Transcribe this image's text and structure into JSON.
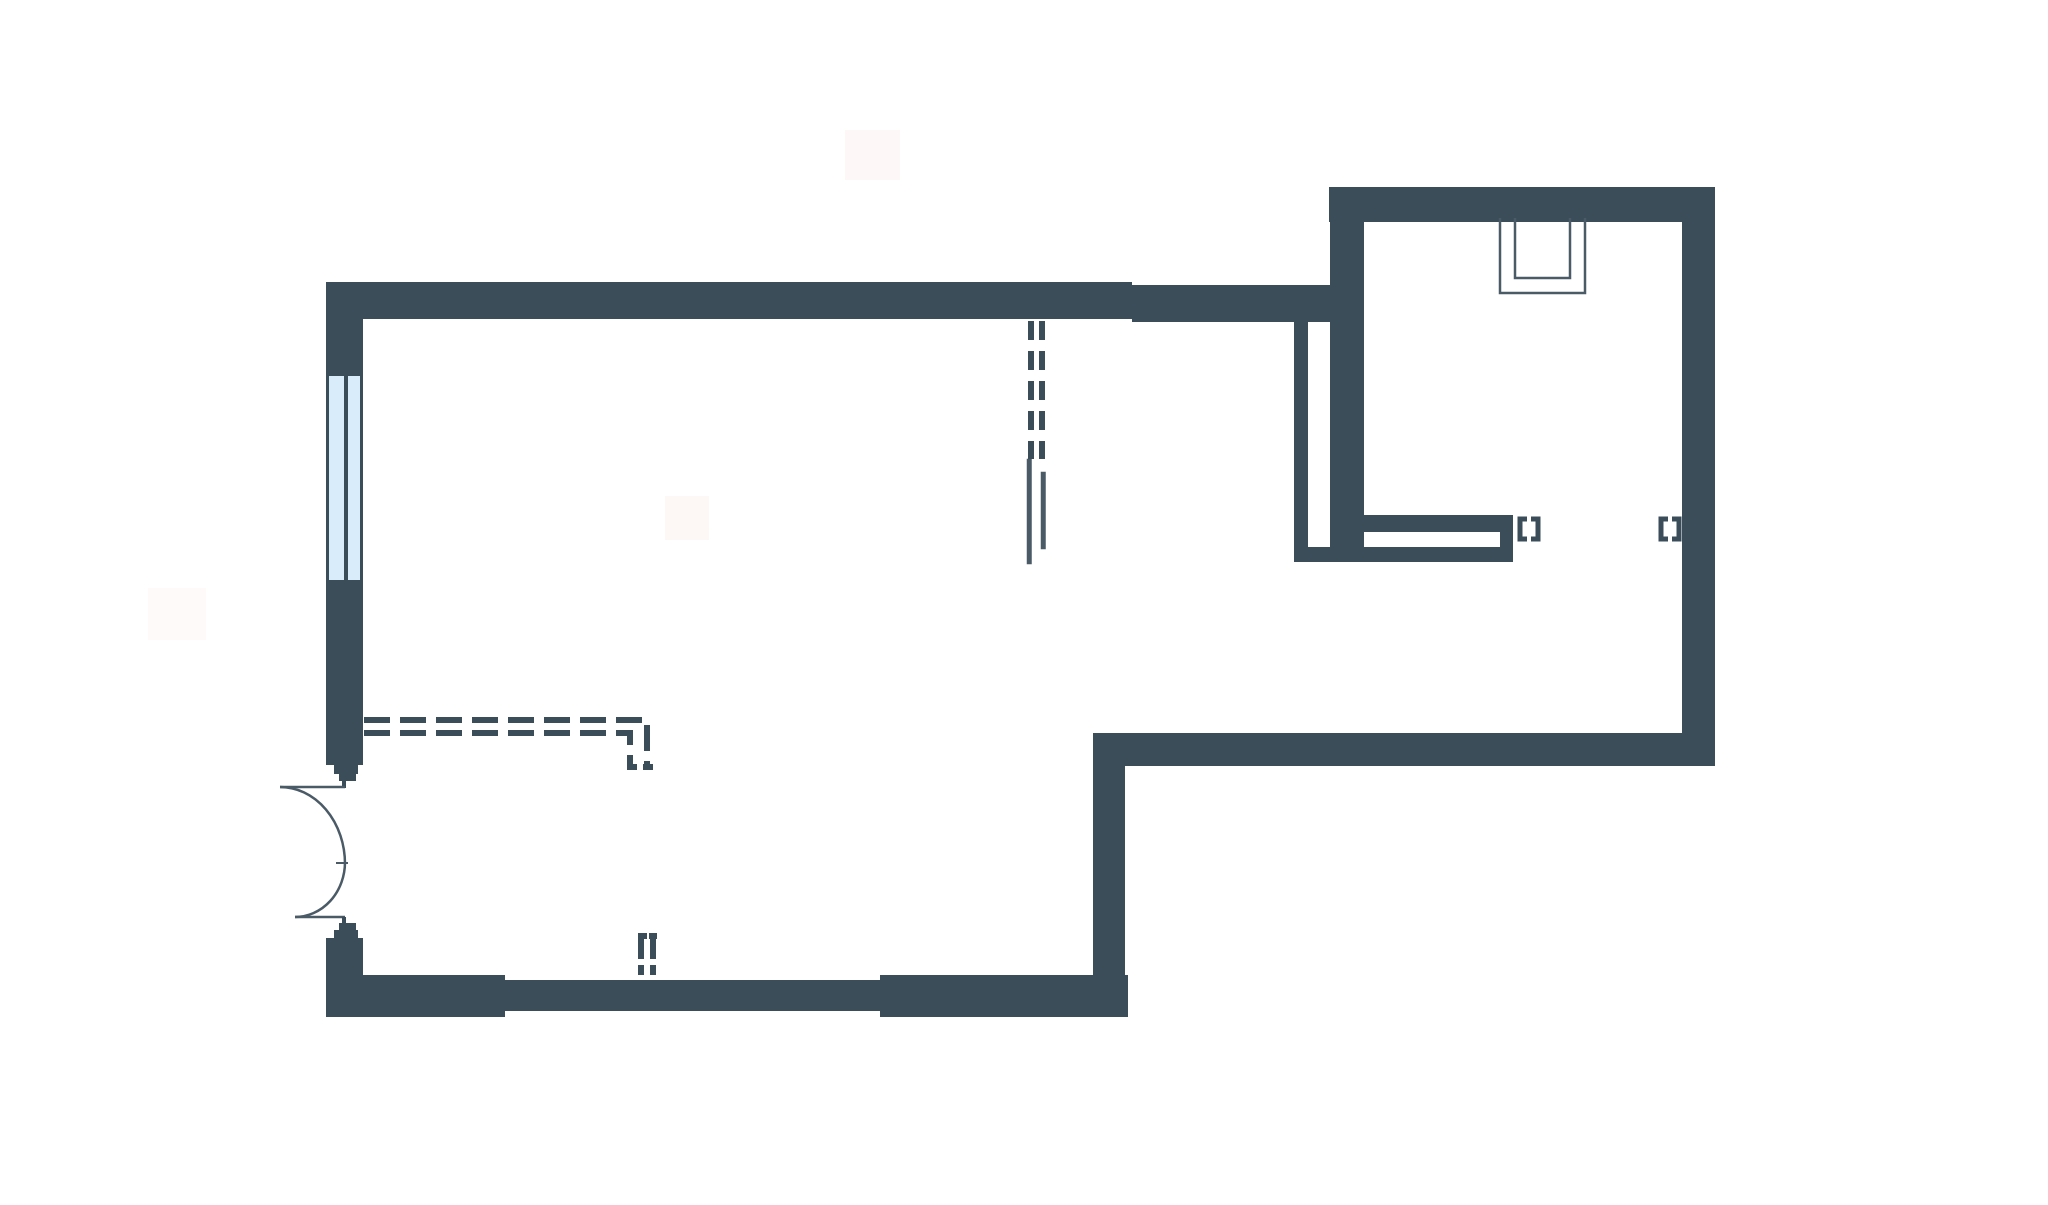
{
  "canvas": {
    "width": 2048,
    "height": 1205,
    "background": "#ffffff"
  },
  "palette": {
    "wall": "#3B4D59",
    "stroke": "#4A5A66",
    "pane": "#D9ECFA",
    "white": "#FFFFFF",
    "blob": "#FBF0ED"
  },
  "shapes": [
    {
      "name": "stain-blob-top",
      "kind": "rect",
      "x": 845,
      "y": 130,
      "w": 55,
      "h": 50,
      "fill": "blob",
      "opacity": 0.45
    },
    {
      "name": "stain-blob-mid",
      "kind": "rect",
      "x": 665,
      "y": 496,
      "w": 44,
      "h": 44,
      "fill": "blob",
      "opacity": 0.5
    },
    {
      "name": "stain-blob-left",
      "kind": "rect",
      "x": 148,
      "y": 588,
      "w": 58,
      "h": 52,
      "fill": "blob",
      "opacity": 0.35
    },
    {
      "name": "top-wall-main",
      "kind": "rect",
      "x": 329,
      "y": 282,
      "w": 803,
      "h": 37,
      "fill": "wall"
    },
    {
      "name": "top-wall-right",
      "kind": "rect",
      "x": 1132,
      "y": 285,
      "w": 198,
      "h": 37,
      "fill": "wall"
    },
    {
      "name": "left-wall-upper",
      "kind": "rect",
      "x": 326,
      "y": 282,
      "w": 37,
      "h": 483,
      "fill": "wall"
    },
    {
      "name": "window-pane-left",
      "kind": "rect",
      "x": 329,
      "y": 376,
      "w": 15,
      "h": 204,
      "fill": "pane"
    },
    {
      "name": "window-pane-right",
      "kind": "rect",
      "x": 348,
      "y": 376,
      "w": 12,
      "h": 204,
      "fill": "pane"
    },
    {
      "name": "door-jamb-upper-outer",
      "kind": "rect",
      "x": 334,
      "y": 765,
      "w": 24,
      "h": 9,
      "fill": "wall"
    },
    {
      "name": "door-jamb-upper-inner",
      "kind": "rect",
      "x": 339,
      "y": 774,
      "w": 17,
      "h": 7,
      "fill": "wall"
    },
    {
      "name": "door-stem-upper",
      "kind": "rect",
      "x": 342,
      "y": 781,
      "w": 4,
      "h": 7,
      "fill": "wall"
    },
    {
      "name": "door-leaf-upper",
      "kind": "line",
      "x1": 280,
      "y1": 787,
      "x2": 345,
      "y2": 787,
      "stroke": "stroke",
      "w": 2.5
    },
    {
      "name": "door-swing-upper",
      "kind": "path",
      "d": "M 280,787 A 65,77 0 0 1 345,864",
      "stroke": "stroke",
      "w": 2.5
    },
    {
      "name": "door-swing-lower",
      "kind": "path",
      "d": "M 295,917 A 50,55 0 0 0 345,862",
      "stroke": "stroke",
      "w": 2.5
    },
    {
      "name": "door-cusp-tick",
      "kind": "line",
      "x1": 336,
      "y1": 863,
      "x2": 348,
      "y2": 863,
      "stroke": "stroke",
      "w": 2
    },
    {
      "name": "door-leaf-lower",
      "kind": "line",
      "x1": 295,
      "y1": 917,
      "x2": 345,
      "y2": 917,
      "stroke": "stroke",
      "w": 2.5
    },
    {
      "name": "door-stem-lower",
      "kind": "rect",
      "x": 342,
      "y": 917,
      "w": 4,
      "h": 6,
      "fill": "wall"
    },
    {
      "name": "door-jamb-lower-inner",
      "kind": "rect",
      "x": 339,
      "y": 923,
      "w": 17,
      "h": 7,
      "fill": "wall"
    },
    {
      "name": "door-jamb-lower-outer",
      "kind": "rect",
      "x": 334,
      "y": 930,
      "w": 24,
      "h": 8,
      "fill": "wall"
    },
    {
      "name": "left-wall-lower",
      "kind": "rect",
      "x": 326,
      "y": 938,
      "w": 37,
      "h": 79,
      "fill": "wall"
    },
    {
      "name": "bottom-wall-left",
      "kind": "rect",
      "x": 326,
      "y": 975,
      "w": 179,
      "h": 42,
      "fill": "wall"
    },
    {
      "name": "bottom-wall-middle",
      "kind": "rect",
      "x": 505,
      "y": 980,
      "w": 375,
      "h": 31,
      "fill": "wall"
    },
    {
      "name": "bottom-wall-right",
      "kind": "rect",
      "x": 880,
      "y": 975,
      "w": 248,
      "h": 42,
      "fill": "wall"
    },
    {
      "name": "step-wall-vertical",
      "kind": "rect",
      "x": 1093,
      "y": 733,
      "w": 32,
      "h": 284,
      "fill": "wall"
    },
    {
      "name": "lower-section-bottom-wall",
      "kind": "rect",
      "x": 1093,
      "y": 733,
      "w": 622,
      "h": 33,
      "fill": "wall"
    },
    {
      "name": "right-wall",
      "kind": "rect",
      "x": 1682,
      "y": 187,
      "w": 33,
      "h": 579,
      "fill": "wall"
    },
    {
      "name": "room-top-wall",
      "kind": "rect",
      "x": 1329,
      "y": 187,
      "w": 386,
      "h": 35,
      "fill": "wall"
    },
    {
      "name": "room-left-wall",
      "kind": "rect",
      "x": 1330,
      "y": 187,
      "w": 34,
      "h": 375,
      "fill": "wall"
    },
    {
      "name": "cavity-wall-line",
      "kind": "rect",
      "x": 1294,
      "y": 320,
      "w": 14,
      "h": 240,
      "fill": "wall"
    },
    {
      "name": "cavity-wall-floor",
      "kind": "rect",
      "x": 1294,
      "y": 547,
      "w": 70,
      "h": 15,
      "fill": "wall"
    },
    {
      "name": "niche-wall",
      "kind": "rect",
      "x": 1364,
      "y": 515,
      "w": 149,
      "h": 47,
      "fill": "wall"
    },
    {
      "name": "niche-slot",
      "kind": "rect",
      "x": 1364,
      "y": 532,
      "w": 136,
      "h": 15,
      "fill": "white"
    },
    {
      "name": "opening-bracket-1-left",
      "kind": "path",
      "d": "M 1527,519 H 1520 V 539 H 1527",
      "stroke": "wall",
      "w": 5
    },
    {
      "name": "opening-bracket-1-right",
      "kind": "path",
      "d": "M 1531,519 H 1538 V 539 H 1531",
      "stroke": "wall",
      "w": 5
    },
    {
      "name": "opening-bracket-2-left",
      "kind": "path",
      "d": "M 1668,519 H 1661 V 539 H 1668",
      "stroke": "wall",
      "w": 5
    },
    {
      "name": "opening-bracket-2-right",
      "kind": "path",
      "d": "M 1672,519 H 1679 V 539 H 1672",
      "stroke": "wall",
      "w": 5
    },
    {
      "name": "shaft-top-right-outer",
      "kind": "path",
      "d": "M 1500,218 V 293 H 1585 V 218",
      "stroke": "stroke",
      "w": 2.5
    },
    {
      "name": "shaft-top-right-inner",
      "kind": "path",
      "d": "M 1515,218 V 278 H 1570 V 218",
      "stroke": "stroke",
      "w": 2.5
    },
    {
      "name": "shaft-mid-outer",
      "kind": "rect",
      "x": 1028,
      "y": 460,
      "w": 2.5,
      "h": 103,
      "fill": "none",
      "stroke": "stroke"
    },
    {
      "name": "shaft-mid-inner",
      "kind": "rect",
      "x": 1042,
      "y": 473,
      "w": 2.5,
      "h": 75,
      "fill": "none",
      "stroke": "stroke"
    },
    {
      "name": "flue-dash-left",
      "kind": "line",
      "x1": 1031,
      "y1": 321,
      "x2": 1031,
      "y2": 459,
      "stroke": "wall",
      "w": 6,
      "dash": "19 11"
    },
    {
      "name": "flue-dash-right",
      "kind": "line",
      "x1": 1042,
      "y1": 321,
      "x2": 1042,
      "y2": 459,
      "stroke": "wall",
      "w": 6,
      "dash": "19 11"
    },
    {
      "name": "ceiling-dash-outer",
      "kind": "path",
      "d": "M 364,720 H 647 V 767",
      "stroke": "wall",
      "w": 6,
      "dash": "26 10"
    },
    {
      "name": "ceiling-dash-inner",
      "kind": "path",
      "d": "M 364,733 H 630 V 764",
      "stroke": "wall",
      "w": 6,
      "dash": "26 10"
    },
    {
      "name": "ceiling-dash-foot-left",
      "kind": "rect",
      "x": 627,
      "y": 764,
      "w": 10,
      "h": 6,
      "fill": "wall"
    },
    {
      "name": "ceiling-dash-foot-right",
      "kind": "rect",
      "x": 643,
      "y": 764,
      "w": 10,
      "h": 6,
      "fill": "wall"
    },
    {
      "name": "pipe-dash-left",
      "kind": "line",
      "x1": 641,
      "y1": 936,
      "x2": 641,
      "y2": 975,
      "stroke": "wall",
      "w": 6,
      "dash": "23 6"
    },
    {
      "name": "pipe-dash-right",
      "kind": "line",
      "x1": 653,
      "y1": 936,
      "x2": 653,
      "y2": 975,
      "stroke": "wall",
      "w": 6,
      "dash": "23 6"
    },
    {
      "name": "pipe-dash-cap-left",
      "kind": "rect",
      "x": 638,
      "y": 933,
      "w": 9,
      "h": 6,
      "fill": "wall"
    },
    {
      "name": "pipe-dash-cap-right",
      "kind": "rect",
      "x": 649,
      "y": 933,
      "w": 8,
      "h": 6,
      "fill": "wall"
    }
  ]
}
